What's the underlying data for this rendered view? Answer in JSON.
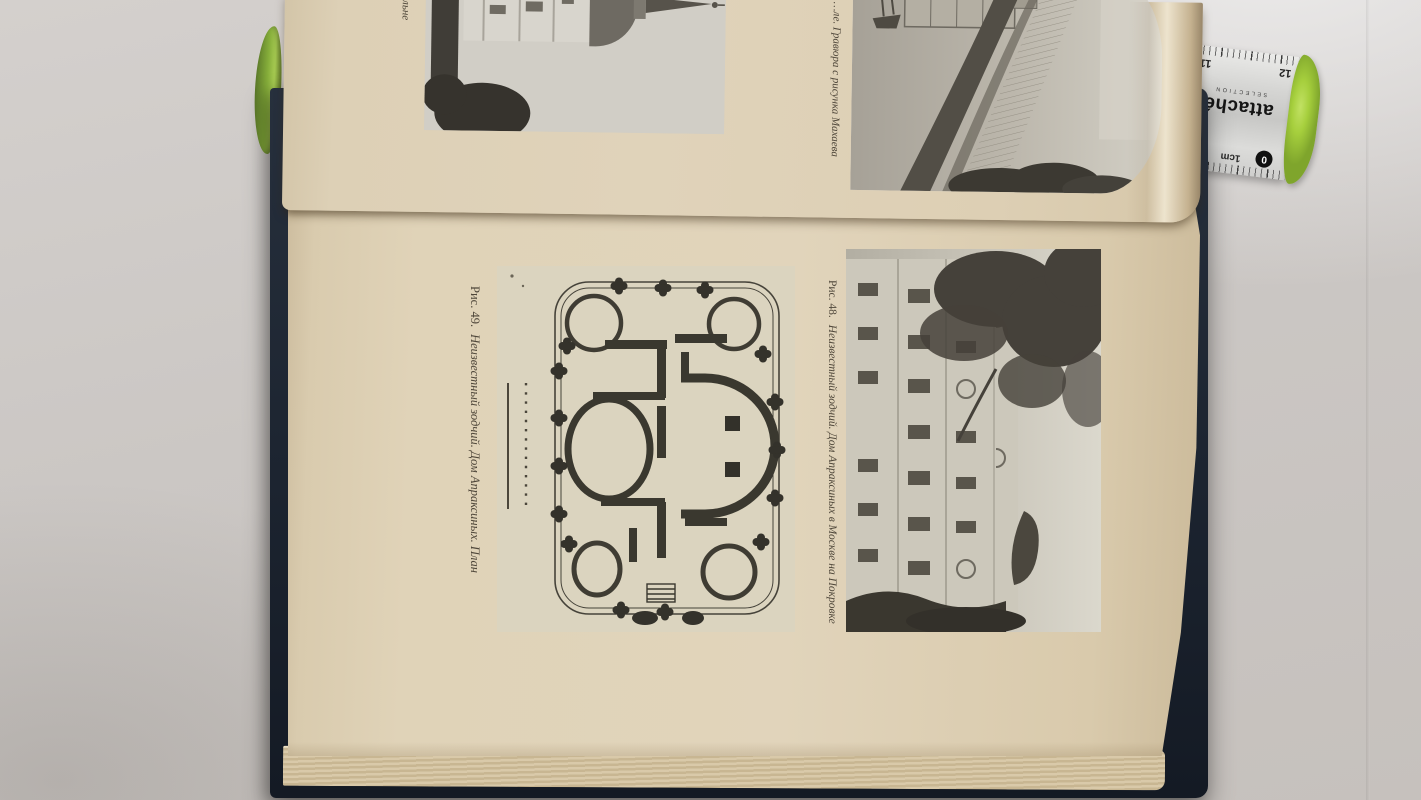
{
  "book": {
    "upper_page": {
      "left_caption_fragment": "…ельне",
      "engraving_caption_fragment": "…ле. Гравюра с рисунка Махаева"
    },
    "main_page": {
      "figure_plan": {
        "label": "Рис. 49.",
        "caption": "Неизвестный зодчий. Дом Апраксиных. План"
      },
      "figure_photo": {
        "label": "Рис. 48.",
        "caption": "Неизвестный зодчий. Дом Апраксиных в Москве на Покровке"
      }
    }
  },
  "ruler": {
    "brand": "attaché",
    "brand_sub": "SELECTION",
    "top_scale_labels": [
      "11",
      "12"
    ],
    "bottom_scale_labels": [
      "2",
      "1cm"
    ],
    "zero_label": "0"
  },
  "colors": {
    "wall": "#cdc9c6",
    "wall_bright": "#ebeae9",
    "page_cream": "#e0d3ba",
    "cover_navy": "#1c2430",
    "pen_green": "#8fb83f",
    "ruler_silver": "#d6d6d4",
    "ruler_cap_green": "#a6cf3d",
    "photo_gray": "#c7c3b7",
    "plan_ink": "#3a382f"
  }
}
